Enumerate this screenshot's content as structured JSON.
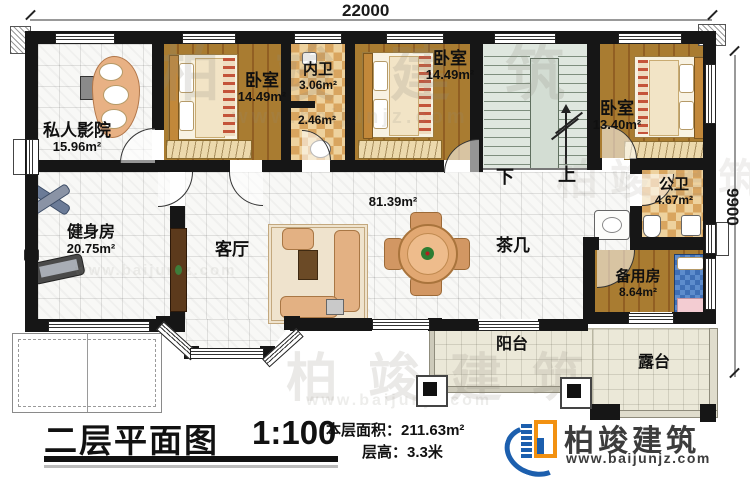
{
  "plan": {
    "dimensions": {
      "width_mm": "22000",
      "depth_mm": "9900"
    },
    "rooms": {
      "cinema": {
        "name": "私人影院",
        "area": "15.96m²"
      },
      "bedroom1": {
        "name": "卧室",
        "area": "14.49m²"
      },
      "inner_bath": {
        "name": "内卫",
        "area_top": "3.06m²",
        "area_bottom": "2.46m²"
      },
      "bedroom2": {
        "name": "卧室",
        "area": "14.49m²"
      },
      "bedroom3": {
        "name": "卧室",
        "area": "13.40m²"
      },
      "public_bath": {
        "name": "公卫",
        "area": "4.67m²"
      },
      "gym": {
        "name": "健身房",
        "area": "20.75m²"
      },
      "living": {
        "name": "客厅",
        "area": "81.39m²"
      },
      "tea_table": {
        "name": "茶几"
      },
      "spare": {
        "name": "备用房",
        "area": "8.64m²"
      },
      "balcony": {
        "name": "阳台"
      },
      "terrace": {
        "name": "露台"
      }
    },
    "stairs": {
      "down": "下",
      "up": "上"
    }
  },
  "titleblock": {
    "title": "二层平面图",
    "scale": "1:100",
    "floor_area_label": "本层面积：",
    "floor_area_value": "211.63m²",
    "floor_height_label": "层高：",
    "floor_height_value": "3.3米"
  },
  "brand": {
    "name": "柏竣建筑",
    "website": "www.baijunjz.com",
    "colors": {
      "blue": "#1c5fae",
      "orange": "#f29111"
    }
  }
}
